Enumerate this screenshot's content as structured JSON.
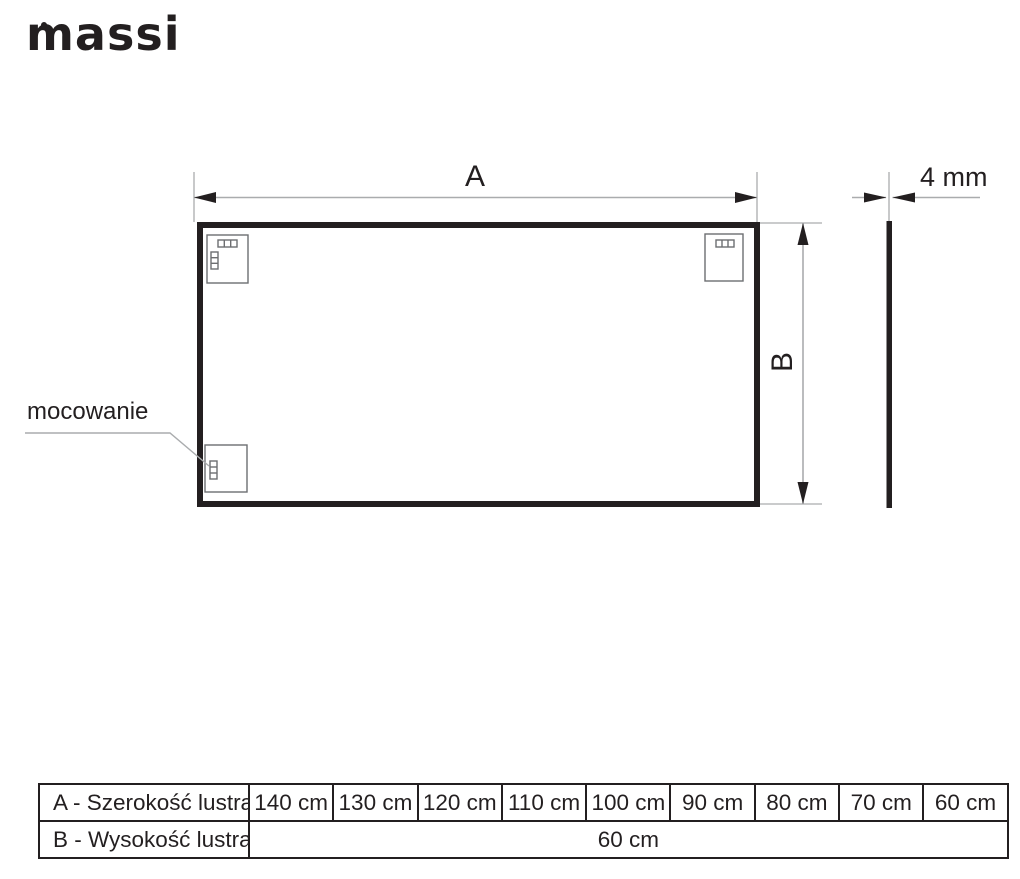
{
  "logo": {
    "text": "massi"
  },
  "diagram": {
    "label_a": "A",
    "label_b": "B",
    "thickness_label": "4 mm",
    "mounting_label": "mocowanie"
  },
  "table": {
    "rows": [
      {
        "label": "A - Szerokość lustra",
        "values": [
          "140 cm",
          "130 cm",
          "120 cm",
          "110 cm",
          "100 cm",
          "90 cm",
          "80 cm",
          "70 cm",
          "60 cm"
        ]
      },
      {
        "label": "B - Wysokość lustra",
        "merged_value": "60 cm"
      }
    ]
  },
  "colors": {
    "ink": "#231f20",
    "dimension_line": "#aaacae",
    "bracket_outline": "#6d6e71"
  }
}
